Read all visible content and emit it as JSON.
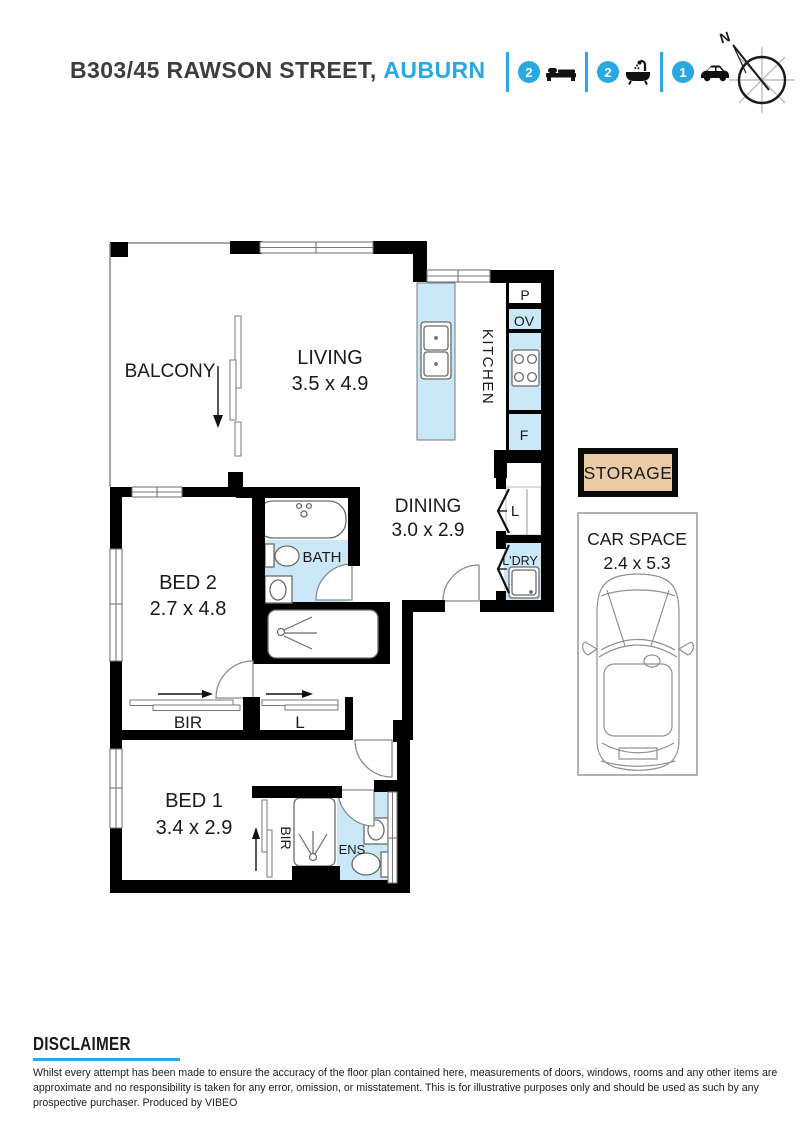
{
  "header": {
    "address": "B303/45 RAWSON STREET,",
    "suburb": "AUBURN",
    "features": [
      {
        "count": "2",
        "icon": "bed-icon"
      },
      {
        "count": "2",
        "icon": "bath-icon"
      },
      {
        "count": "1",
        "icon": "car-icon"
      }
    ],
    "compass": "N"
  },
  "plan": {
    "balcony": {
      "label": "BALCONY"
    },
    "living": {
      "label": "LIVING",
      "dims": "3.5 x 4.9"
    },
    "kitchen": {
      "label": "KITCHEN",
      "pantry": "P",
      "oven": "OV",
      "fridge": "F"
    },
    "dining": {
      "label": "DINING",
      "dims": "3.0 x 2.9"
    },
    "linen": {
      "label": "L"
    },
    "laundry": {
      "label": "L'DRY"
    },
    "bath": {
      "label": "BATH"
    },
    "bed2": {
      "label": "BED 2",
      "dims": "2.7 x 4.8",
      "robe": "BIR",
      "linen": "L"
    },
    "bed1": {
      "label": "BED 1",
      "dims": "3.4 x 2.9",
      "robe": "BIR"
    },
    "ensuite": {
      "label": "ENS"
    },
    "storage": {
      "label": "STORAGE"
    },
    "car_space": {
      "label": "CAR SPACE",
      "dims": "2.4 x 5.3"
    }
  },
  "disclaimer": {
    "title": "DISCLAIMER",
    "body": "Whilst every attempt  has been made to ensure the accuracy of the floor plan contained here, measurements of doors, windows, rooms and any other items are approximate and no responsibility is taken for any error, omission, or misstatement. This is for illustrative purposes only and should be used as such by any prospective purchaser. Produced by VIBEO"
  },
  "colors": {
    "accent": "#29A9E1",
    "room_fill": "#CBE8F8",
    "storage_fill": "#EACBA5"
  }
}
